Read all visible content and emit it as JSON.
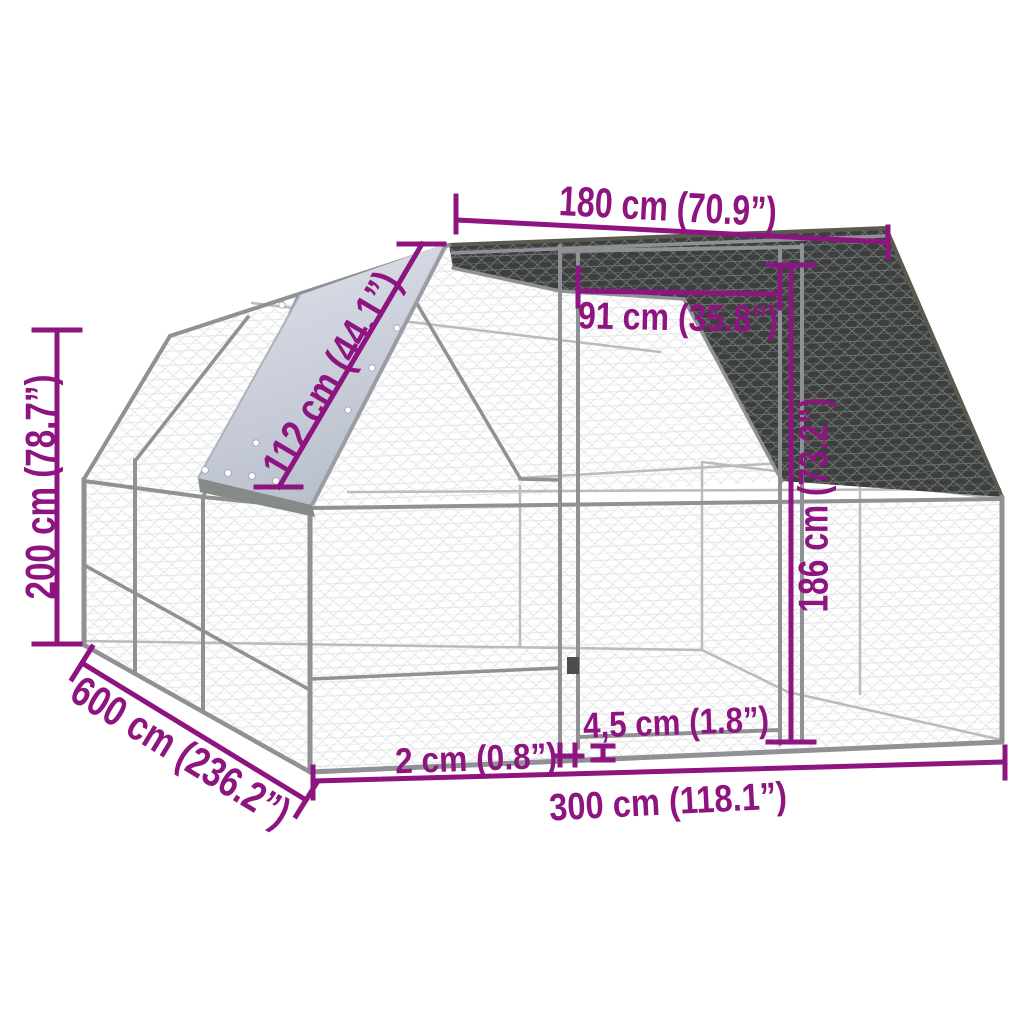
{
  "figure": {
    "type": "product-dimension-diagram",
    "subject": "outdoor chicken coop / walk-in run with mesh panels, door and roof tarp"
  },
  "colors": {
    "accent": "#8E1480",
    "frame": "#8f9194",
    "mesh_dark": "#3c3f3e",
    "tarp": "#ccd1dc",
    "background": "#ffffff"
  },
  "dims": {
    "top_width": "180 cm (70.9”)",
    "door_width": "91 cm (35.8”)",
    "roof_panel": "112 cm (44.1”)",
    "height": "200 cm (78.7”)",
    "door_height": "186 cm (73.2”)",
    "depth": "600 cm (236.2”)",
    "tube": "2 cm (0.8”)",
    "clearance": "4,5 cm (1.8”)",
    "width": "300 cm (118.1”)"
  }
}
